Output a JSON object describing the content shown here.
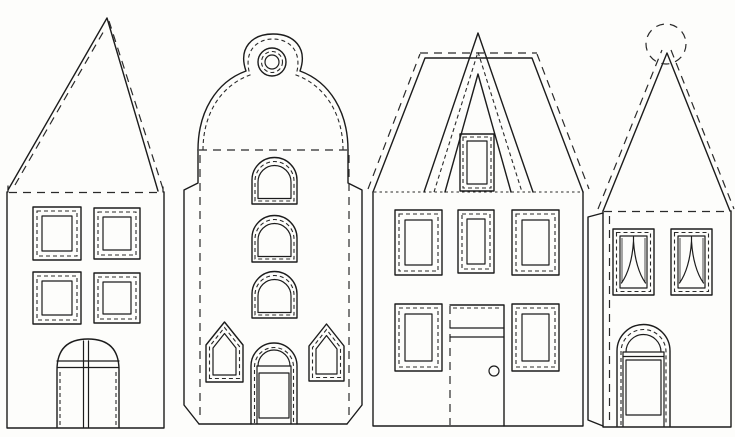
{
  "page": {
    "background": "#fdfdfb",
    "line_color": "#1c1c1c",
    "description": "Black-and-white paper craft template sheet with four cut-out house facades; solid lines are cut lines, dashed lines are fold/stitch lines"
  },
  "houses": [
    {
      "id": "house-1",
      "label": "Tall gable house",
      "roof": "steep triangular gable with dashed fold lines",
      "windows": "four square double-framed windows",
      "door": "arched door with cross glazing bars"
    },
    {
      "id": "house-2",
      "label": "Bell-gable canal house",
      "roof": "bell-shaped gable topped by a round bullseye window",
      "windows": "three stacked arched windows and two pointed gothic windows",
      "door": "arched door with fanlight and lower panel"
    },
    {
      "id": "house-3",
      "label": "A-frame roof house",
      "roof": "trapezoid gable crossed by an A-shaped roof trim with attic window",
      "windows": "five rectangular double-framed windows",
      "door": "tall door with transom band and round doorknob"
    },
    {
      "id": "house-4",
      "label": "Spire house with ball finial",
      "roof": "triangular spire with dashed ball ornament on top",
      "windows": "two rectangular windows with parted curtains",
      "door": "arched door with fanlight and lower panel"
    }
  ]
}
